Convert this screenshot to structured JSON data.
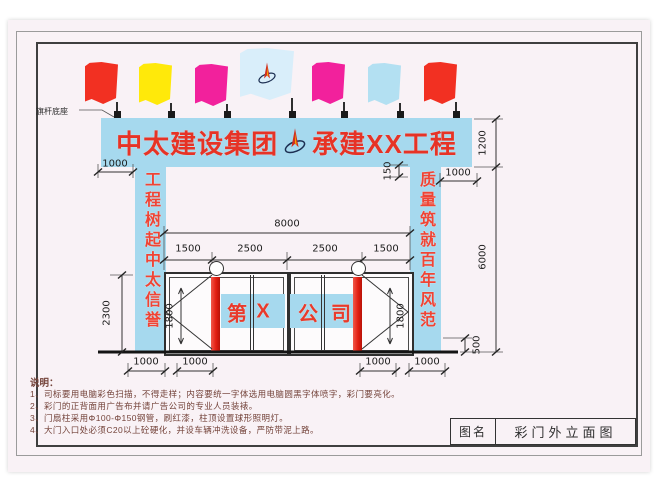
{
  "banner": {
    "left": "中太建设集团",
    "right": "承建XX工程",
    "logo": "zhongtai-star-logo"
  },
  "flag_base_label": "旗杆底座",
  "flags": [
    {
      "name": "flag-red",
      "color": "#f23022"
    },
    {
      "name": "flag-yellow",
      "color": "#ffe90a"
    },
    {
      "name": "flag-magenta",
      "color": "#f2219c"
    },
    {
      "name": "flag-company-logo",
      "color": "#d9eefa"
    },
    {
      "name": "flag-magenta",
      "color": "#f2219c"
    },
    {
      "name": "flag-light-blue",
      "color": "#b3e0f2"
    },
    {
      "name": "flag-red",
      "color": "#f23022"
    }
  ],
  "pillars": {
    "left": "工程树起中太信誉",
    "right": "质量筑就百年风范"
  },
  "gate": {
    "letters": [
      "第",
      "X",
      "公",
      "司"
    ]
  },
  "dims": {
    "top_left_1000": "1000",
    "top_right_1000": "1000",
    "step_150": "150",
    "banner_1200": "1200",
    "overall_8000": "8000",
    "seg_1500_a": "1500",
    "seg_2500_a": "2500",
    "seg_2500_b": "2500",
    "seg_1500_b": "1500",
    "height_2300": "2300",
    "door_1800_left": "1800",
    "door_1800_right": "1800",
    "pillar_6000": "6000",
    "footing_500": "500",
    "bottom_1000_a": "1000",
    "bottom_1000_b": "1000",
    "bottom_1000_c": "1000",
    "bottom_1000_d": "1000"
  },
  "notes": {
    "heading": "说明：",
    "items": [
      "1、司标要用电脑彩色扫描，不得走样；内容要统一字体选用电脑圆黑字体喷字，彩门要亮化。",
      "2、彩门的正背面用广告布并请广告公司的专业人员装裱。",
      "3、门扇柱采用Φ100-Φ150钢管，刷红漆，柱顶设置球形照明灯。",
      "4、大门入口处必须C20以上砼硬化，并设车辆冲洗设备，严防带泥上路。"
    ]
  },
  "title_block": {
    "label": "图名",
    "value": "彩门外立面图"
  },
  "colors": {
    "accent_blue": "#a6d9ee",
    "brand_red": "#e8382b",
    "pole_red": "#e8241a",
    "paper": "#f9f2f6"
  }
}
